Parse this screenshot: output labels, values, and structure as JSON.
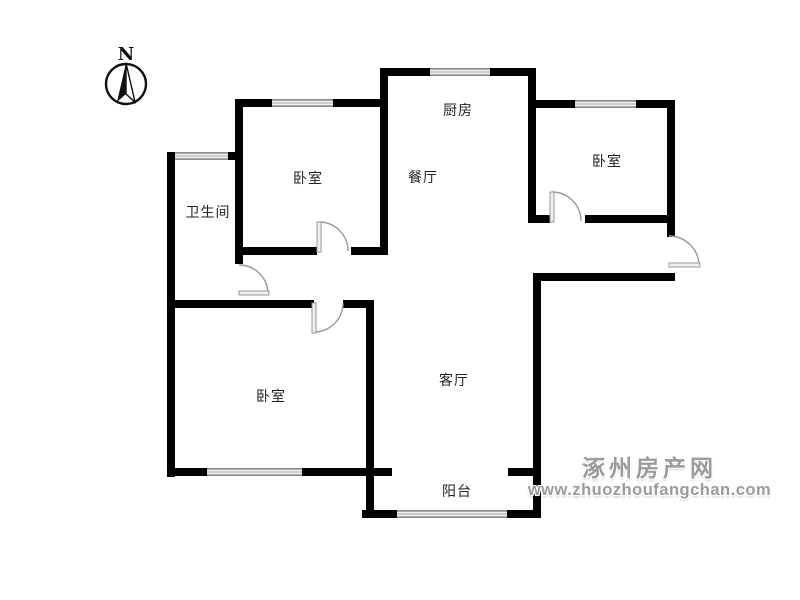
{
  "compass": {
    "label": "N"
  },
  "rooms": {
    "kitchen": {
      "label": "厨房"
    },
    "dining": {
      "label": "餐厅"
    },
    "bedroom_top": {
      "label": "卧室"
    },
    "bedroom_right": {
      "label": "卧室"
    },
    "bathroom": {
      "label": "卫生间"
    },
    "bedroom_left": {
      "label": "卧室"
    },
    "living_room": {
      "label": "客厅"
    },
    "balcony": {
      "label": "阳台"
    }
  },
  "watermark": {
    "site_name": "涿州房产网",
    "site_url": "www.zhuozhoufangchan.com"
  },
  "colors": {
    "wall": "#000000",
    "window": "#a8a8a8",
    "door": "#999999",
    "label_text": "#222222",
    "watermark_text": "#9b9b9b"
  }
}
